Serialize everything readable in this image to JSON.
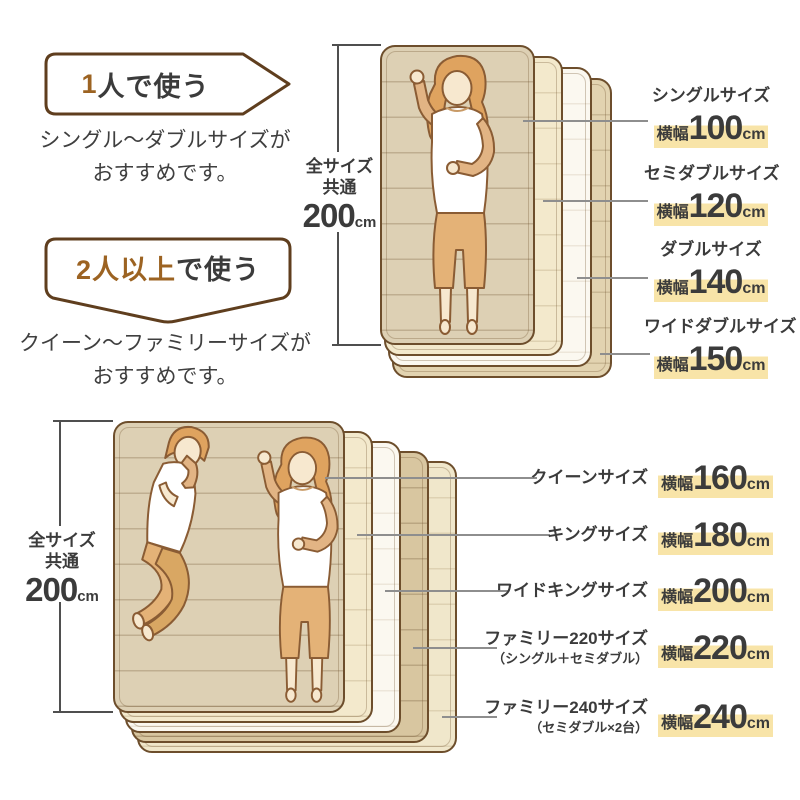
{
  "guide_single": {
    "banner_accent": "1",
    "banner_rest": "人で使う",
    "desc1": "シングル〜ダブルサイズが",
    "desc2": "おすすめです。"
  },
  "guide_multi": {
    "banner_accent": "2人以上",
    "banner_rest": "で使う",
    "desc1": "クイーン〜ファミリーサイズが",
    "desc2": "おすすめです。"
  },
  "common_height_top": {
    "line1": "全サイズ",
    "line2": "共通",
    "value": "200",
    "unit": "cm"
  },
  "common_height_bottom": {
    "line1": "全サイズ",
    "line2": "共通",
    "value": "200",
    "unit": "cm"
  },
  "single_stack_labels": [
    {
      "name": "シングルサイズ",
      "width_label": "横幅",
      "value": "100",
      "unit": "cm"
    },
    {
      "name": "セミダブルサイズ",
      "width_label": "横幅",
      "value": "120",
      "unit": "cm"
    },
    {
      "name": "ダブルサイズ",
      "width_label": "横幅",
      "value": "140",
      "unit": "cm"
    },
    {
      "name": "ワイドダブルサイズ",
      "width_label": "横幅",
      "value": "150",
      "unit": "cm"
    }
  ],
  "multi_stack_labels": [
    {
      "name": "クイーンサイズ",
      "note": "",
      "width_label": "横幅",
      "value": "160",
      "unit": "cm"
    },
    {
      "name": "キングサイズ",
      "note": "",
      "width_label": "横幅",
      "value": "180",
      "unit": "cm"
    },
    {
      "name": "ワイドキングサイズ",
      "note": "",
      "width_label": "横幅",
      "value": "200",
      "unit": "cm"
    },
    {
      "name": "ファミリー220サイズ",
      "note": "（シングル＋セミダブル）",
      "width_label": "横幅",
      "value": "220",
      "unit": "cm"
    },
    {
      "name": "ファミリー240サイズ",
      "note": "（セミダブル×2台）",
      "width_label": "横幅",
      "value": "240",
      "unit": "cm"
    }
  ],
  "colors": {
    "accent_brown": "#9c6322",
    "outline_brown": "#5f3e1e",
    "highlight_yellow": "#f8e4a8",
    "text": "#3b3b3b",
    "mattress_front": "#ddd0b4"
  }
}
